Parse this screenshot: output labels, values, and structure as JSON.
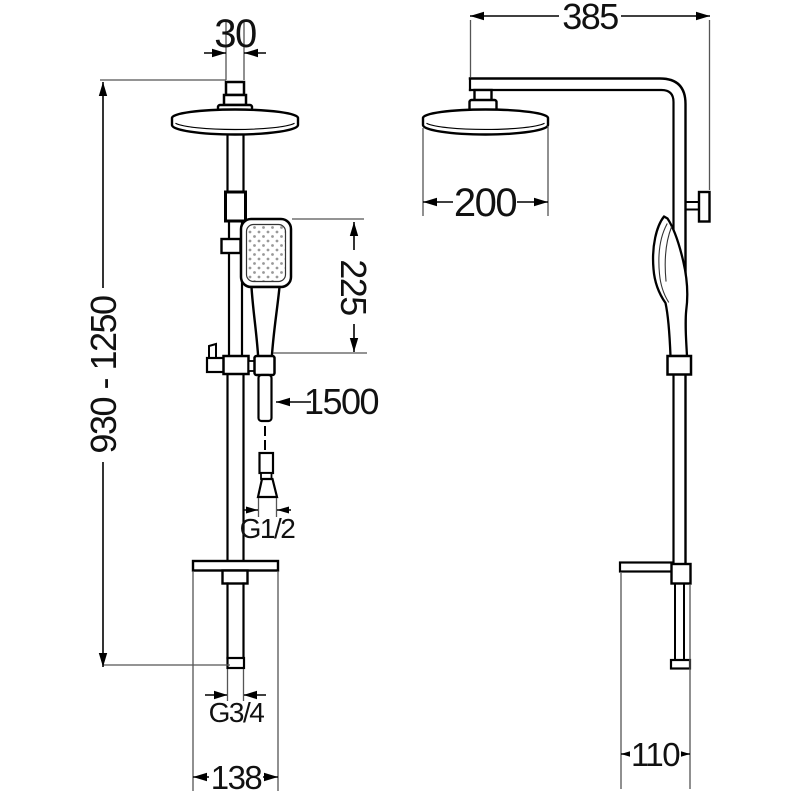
{
  "colors": {
    "line": "#000000",
    "extension": "#555555",
    "text": "#111111",
    "background": "#ffffff",
    "spray_dot": "#999999"
  },
  "dimensions": {
    "head_connector_diameter": "30",
    "column_height_range": "930 - 1250",
    "hand_shower_length": "225",
    "hose_length": "1500",
    "hose_thread": "G1/2",
    "bottom_thread": "G3/4",
    "base_width": "138",
    "arm_reach": "385",
    "head_diameter": "200",
    "side_depth": "110"
  }
}
